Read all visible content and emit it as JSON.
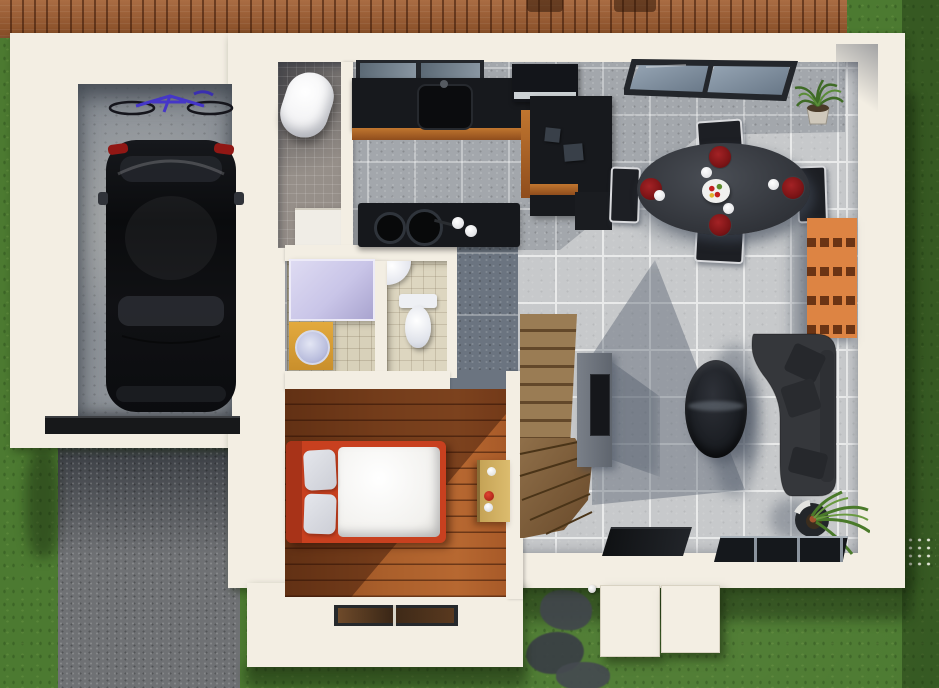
{
  "scene": {
    "type": "3d-floor-plan-render",
    "view": "top-down isometric",
    "description": "Architectural 3D visualization of a small house ground floor with garage, open living/dining/kitchen, bedroom, two bathrooms and WC, winder staircase, wood deck, lawn, driveway and stepping stones"
  },
  "palette": {
    "walls": "#f3eee3",
    "deck_wood": "#a05c2e",
    "grass": "#4c7a31",
    "driveway": "#6f7174",
    "concrete": "#8d9298",
    "tile_light": "#c7c9cb",
    "tile_grout": "#e9eaea",
    "tile_dark": "#a3a7ac",
    "entry_tile": "#6b7480",
    "counter_black": "#17191d",
    "island_black": "#16181c",
    "wood_trim": "#8f4d1d",
    "table_gray": "#33363c",
    "chair_dark": "#1d1f24",
    "chair_frame": "#d9dadd",
    "plate_red": "#7c1416",
    "sofa_gray": "#35373b",
    "coffee_dark": "#1a1d22",
    "stairs_wood": "#9a7c54",
    "stairs_riser": "#63482a",
    "bedroom_floor": "#a85c2a",
    "bed_frame": "#c8401f",
    "duvet": "#f2f1ee",
    "pillow": "#ccced6",
    "desk_wood": "#dcbc6e",
    "shower_glass": "#c9c5e8",
    "vanity_yellow": "#e3aa3e",
    "porcelain": "#eef0f4",
    "bathtub": "#f0f0f2",
    "bath_floor": "#968f89",
    "small_bath_floor": "#d8d1ba",
    "shelf_orange": "#dd8443",
    "shelf_slot": "#6b3414",
    "glass_blue": "#7e8d9d",
    "window_frame": "#23262b",
    "car_black": "#0e0f12",
    "taillight_red": "#911714",
    "bike_blue": "#4536c8",
    "plant_green": "#4a7a2a",
    "stone_gray": "#41464c",
    "washer": "#f0ede6",
    "tv_gray": "#5f656e",
    "screen_black": "#15171b"
  },
  "areas": {
    "deck": {
      "label": "wood deck terrace"
    },
    "garage": {
      "label": "garage",
      "contents": [
        "bicycle",
        "black car",
        "sectional garage door",
        "concrete floor"
      ]
    },
    "driveway": {
      "label": "asphalt driveway"
    },
    "bathroom_main": {
      "label": "main bathroom",
      "contents": [
        "bathtub",
        "washing machine"
      ]
    },
    "kitchen": {
      "label": "kitchen",
      "contents": [
        "window",
        "counter with sink",
        "tall cabinet with hood",
        "L-shaped counter",
        "island with cooktop"
      ]
    },
    "dining": {
      "label": "dining area",
      "contents": [
        "oval table",
        "four chairs",
        "four red plates",
        "four cups",
        "fruit centerpiece",
        "corner window",
        "potted plant",
        "orange shelf unit"
      ]
    },
    "living": {
      "label": "living room",
      "contents": [
        "sectional sofa with cushions",
        "oval coffee table",
        "tv unit",
        "floor plant",
        "glass door",
        "low window"
      ]
    },
    "shower_room": {
      "label": "shower room",
      "contents": [
        "glass shower",
        "yellow vanity with round sink"
      ]
    },
    "wc": {
      "label": "toilet room",
      "contents": [
        "corner sink",
        "toilet"
      ]
    },
    "entry": {
      "label": "entry hall with slate tiles"
    },
    "stairs": {
      "label": "wood winder staircase"
    },
    "bedroom": {
      "label": "bedroom",
      "contents": [
        "bed with red frame",
        "white duvet",
        "two pillows",
        "desk",
        "window"
      ]
    },
    "exterior": {
      "label": "yard",
      "contents": [
        "lawn",
        "stepping stones",
        "open shutter doors",
        "white flowers"
      ]
    }
  }
}
